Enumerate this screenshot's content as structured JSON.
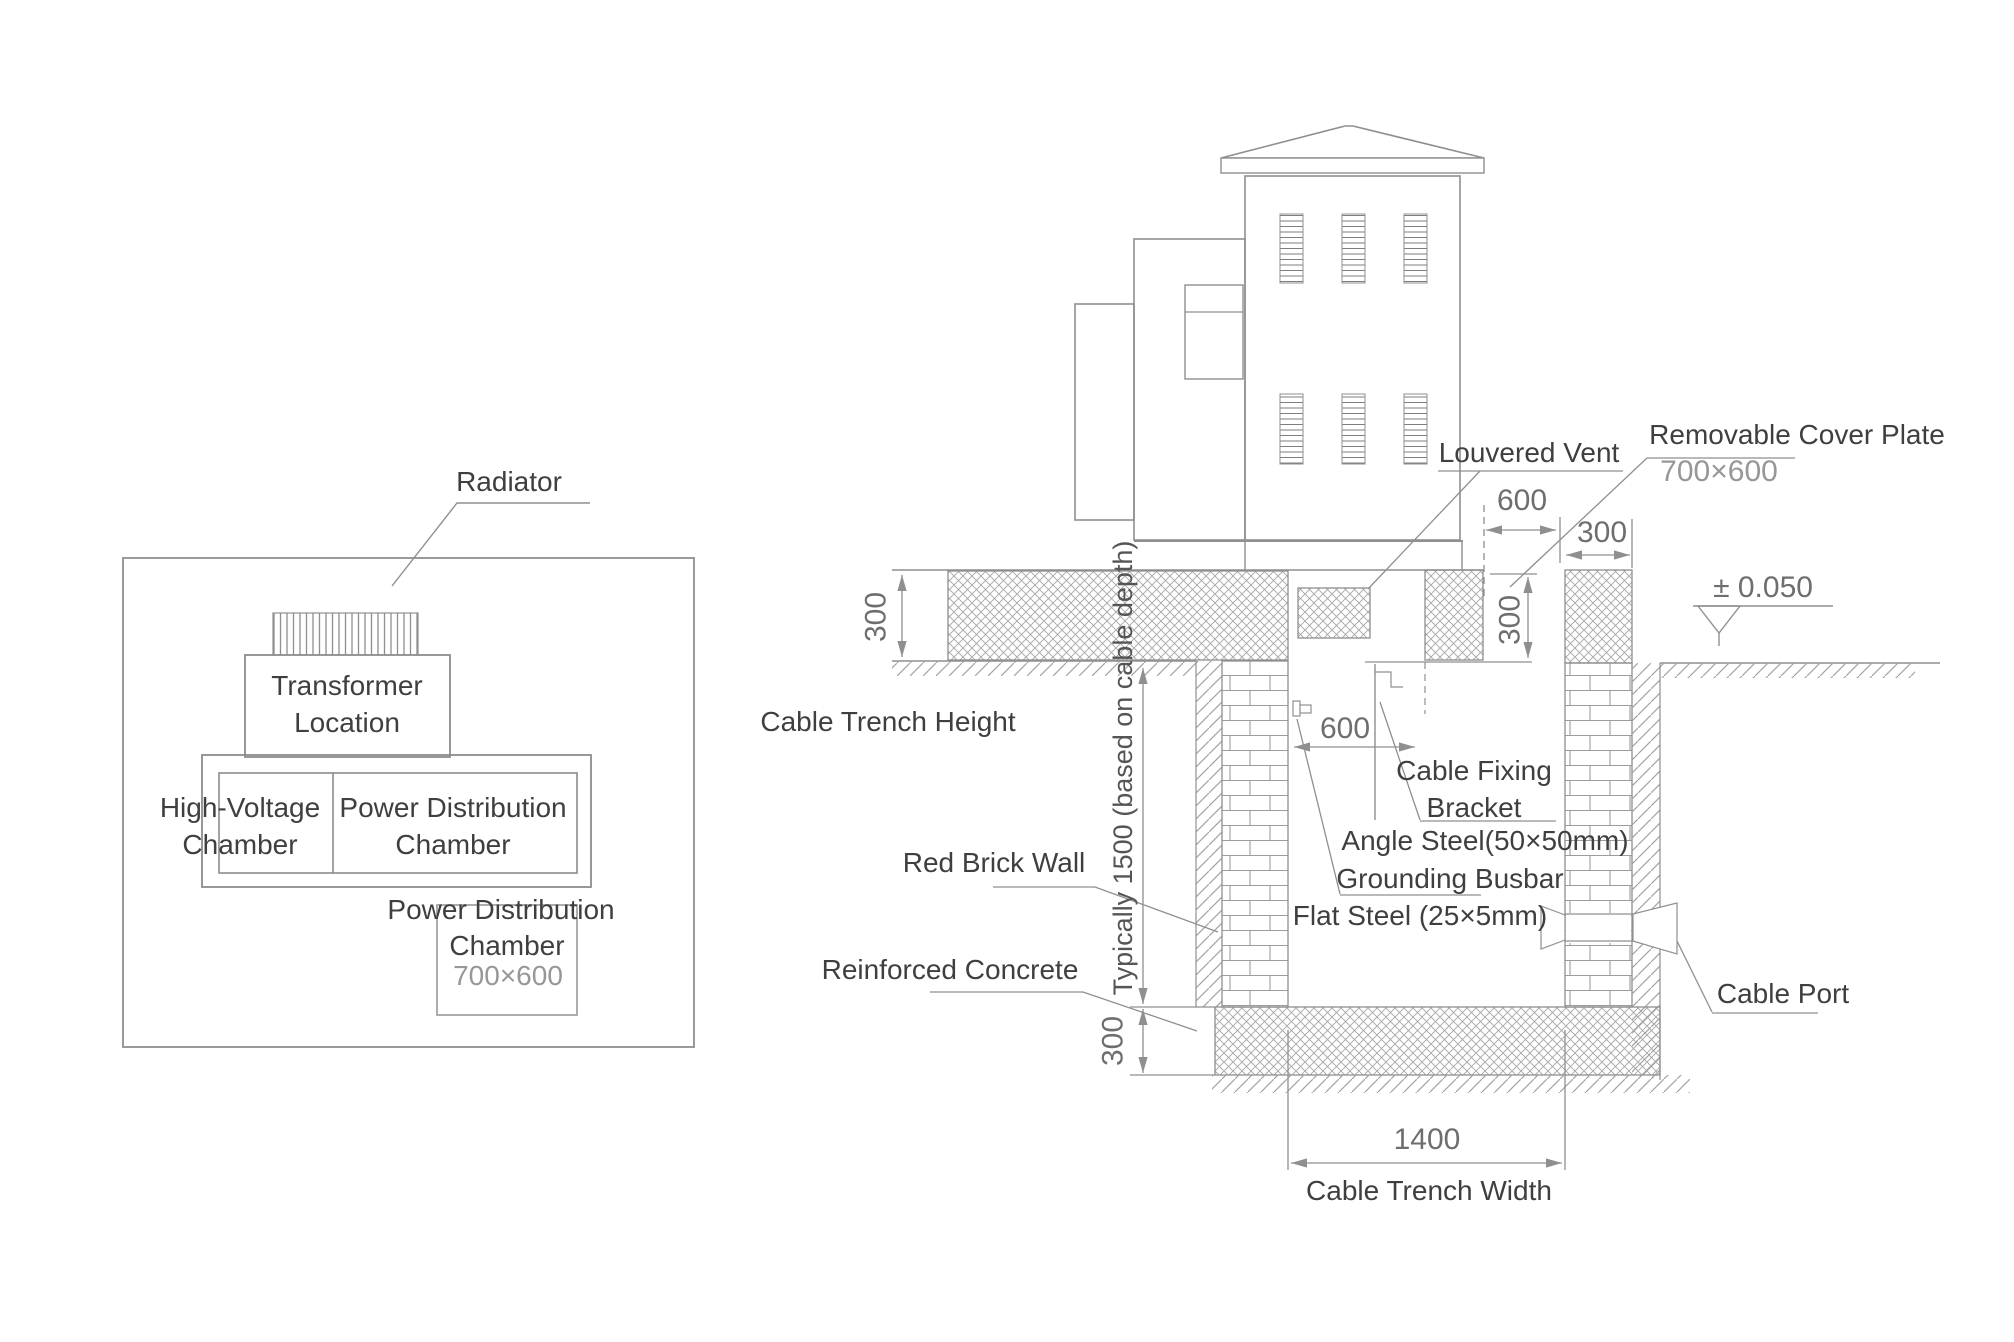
{
  "plan": {
    "radiator": "Radiator",
    "transformer": [
      "Transformer",
      "Location"
    ],
    "high_voltage_chamber": [
      "High-Voltage",
      "Chamber"
    ],
    "power_distribution_chamber": [
      "Power Distribution",
      "Chamber"
    ],
    "power_distribution_chamber_below": [
      "Power Distribution",
      "Chamber"
    ],
    "power_distribution_chamber_size": "700×600"
  },
  "section": {
    "louvered_vent": "Louvered Vent",
    "removable_cover_plate": "Removable Cover Plate",
    "removable_cover_plate_size": "700×600",
    "level_mark": "± 0.050",
    "cable_trench_height": "Cable Trench Height",
    "red_brick_wall": "Red Brick Wall",
    "reinforced_concrete": "Reinforced Concrete",
    "cable_fixing_bracket": [
      "Cable Fixing",
      "Bracket"
    ],
    "angle_steel": "Angle Steel(50×50mm)",
    "grounding_busbar": "Grounding Busbar",
    "flat_steel": "Flat Steel (25×5mm)",
    "cable_port": "Cable Port",
    "cable_trench_width": "Cable Trench Width",
    "depth_note": "Typically 1500 (based on cable depth)",
    "dim_slab_300": "300",
    "dim_cover_600": "600",
    "dim_pier_300": "300",
    "dim_elev_300": "300",
    "dim_bracket_600": "600",
    "dim_base_300": "300",
    "dim_width_1400": "1400"
  },
  "colors": {
    "line": "#8f8f8f",
    "hatch": "#a5a5a5",
    "text": "#3f3f3f",
    "dim_text": "#6e6e6e",
    "value_text": "#979797"
  }
}
